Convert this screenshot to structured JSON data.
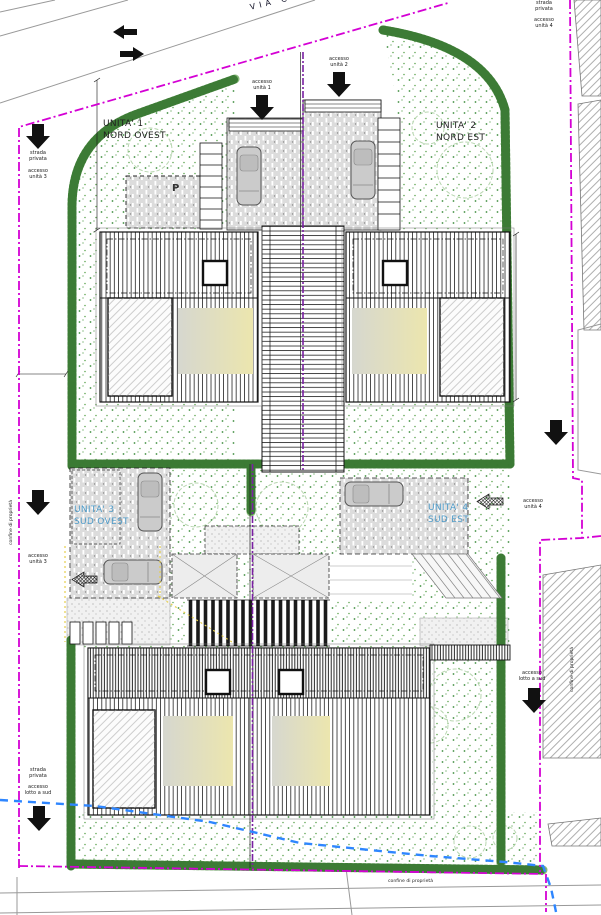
{
  "street": {
    "name": "VIA CEN"
  },
  "units": {
    "u1": {
      "line1": "UNITA' 1",
      "line2": "NORD OVEST"
    },
    "u2": {
      "line1": "UNITA' 2",
      "line2": "NORD EST"
    },
    "u3": {
      "line1": "UNITA' 3",
      "line2": "SUD OVEST"
    },
    "u4": {
      "line1": "UNITA' 4",
      "line2": "SUD EST"
    }
  },
  "labels": {
    "accesso_unita_1": {
      "line1": "accesso",
      "line2": "unità 1"
    },
    "accesso_unita_2": {
      "line1": "accesso",
      "line2": "unità 2"
    },
    "accesso_unita_3": {
      "line1": "accesso",
      "line2": "unità 3"
    },
    "accesso_unita_4": {
      "line1": "accesso",
      "line2": "unità 4"
    },
    "accesso_lotto_sud": {
      "line1": "accesso",
      "line2": "lotto a sud"
    },
    "strada_privata": {
      "line1": "strada",
      "line2": "privata"
    },
    "confine": "confine di proprietà",
    "parcheggio": "P"
  },
  "colors": {
    "boundary": "#d400d4",
    "division": "#7a1fa2",
    "hedge": "#3f8f3f",
    "garden_dot": "#4e9a44",
    "water": "#2e86ff",
    "unit_blue": "#4f9bc8",
    "beige": "#eae4ae",
    "road_gray": "#999999",
    "arrow_black": "#111111",
    "yellow": "#e6cf4e"
  }
}
